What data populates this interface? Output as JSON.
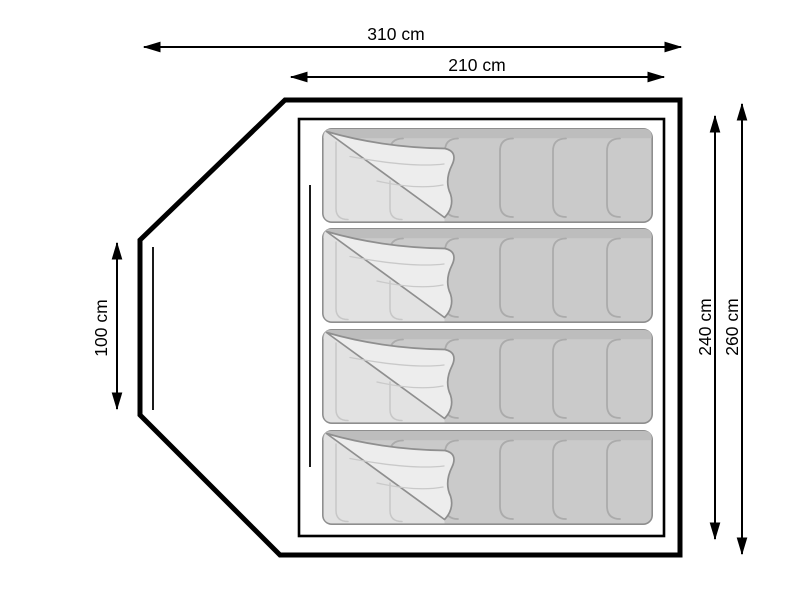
{
  "diagram": {
    "subject": "Tent floor plan top view with four sleeping bags",
    "dimension_labels": {
      "total_width": "310 cm",
      "inner_width": "210 cm",
      "porch_depth": "100 cm",
      "inner_depth": "240 cm",
      "total_depth": "260 cm"
    },
    "sleeping_bag_count": "4",
    "colors": {
      "line": "#000000",
      "background": "#ffffff",
      "bag_body": "#cacaca",
      "bag_top_band": "#bdbdbd",
      "bag_seam": "#ababab",
      "bag_outline": "#8e8e8e",
      "bag_flap": "#ededed",
      "bag_under": "#e2e2e2",
      "bag_faint_seam": "#c7c7c7",
      "bag_flap_edge": "#8f8f8f"
    }
  }
}
